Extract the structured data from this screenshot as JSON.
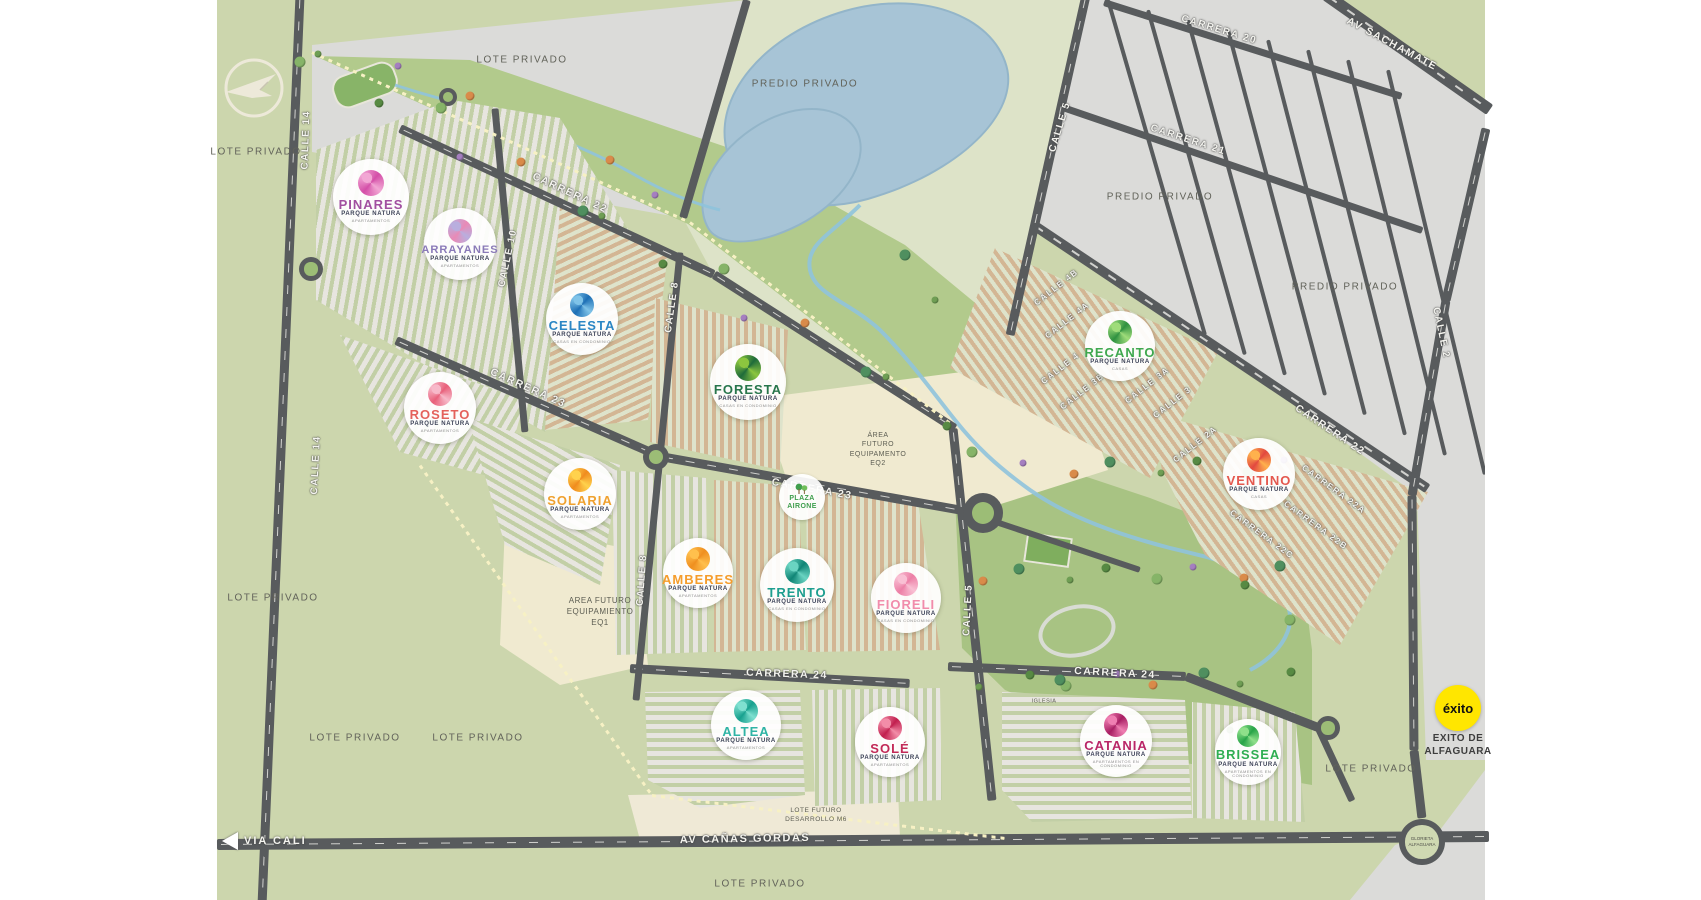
{
  "map": {
    "colors": {
      "page_margin": "#ffffff",
      "base_green": "#ccd6ad",
      "pale_parcel": "#dde3c8",
      "gray_parcel": "#dbdbd9",
      "park_green": "#aec98a",
      "beige_area": "#f0ead0",
      "road": "#585b5d",
      "lake": "#a7c4d6",
      "boundary_dots": "#f7f1c4",
      "exito_yellow": "#ffe600"
    },
    "parcel_labels": [
      {
        "text": "LOTE PRIVADO",
        "x": 256,
        "y": 152
      },
      {
        "text": "LOTE PRIVADO",
        "x": 522,
        "y": 60
      },
      {
        "text": "LOTE PRIVADO",
        "x": 273,
        "y": 598
      },
      {
        "text": "LOTE PRIVADO",
        "x": 355,
        "y": 738
      },
      {
        "text": "LOTE PRIVADO",
        "x": 478,
        "y": 738
      },
      {
        "text": "LOTE PRIVADO",
        "x": 760,
        "y": 884
      },
      {
        "text": "LOTE PRIVADO",
        "x": 1371,
        "y": 769
      },
      {
        "text": "PREDIO PRIVADO",
        "x": 805,
        "y": 84
      },
      {
        "text": "PREDIO PRIVADO",
        "x": 1160,
        "y": 197
      },
      {
        "text": "PREDIO PRIVADO",
        "x": 1345,
        "y": 287
      }
    ],
    "area_labels": [
      {
        "text": "ÁREA\nFUTURO\nEQUIPAMENTO\nEQ2",
        "x": 878,
        "y": 450,
        "size": 7
      },
      {
        "text": "AREA FUTURO\nEQUIPAMIENTO\nEQ1",
        "x": 600,
        "y": 612,
        "size": 8
      },
      {
        "text": "LOTE FUTURO\nDESARROLLO M6",
        "x": 816,
        "y": 816,
        "size": 6.5
      },
      {
        "text": "IGLESIA",
        "x": 1044,
        "y": 702,
        "size": 5.5
      }
    ],
    "street_labels": [
      {
        "text": "CALLE 14",
        "x": 306,
        "y": 140,
        "rot": -88,
        "size": 10
      },
      {
        "text": "CALLE 14",
        "x": 316,
        "y": 465,
        "rot": -87,
        "size": 10
      },
      {
        "text": "CARRERA 22",
        "x": 570,
        "y": 193,
        "rot": 25,
        "size": 10.5
      },
      {
        "text": "CALLE 10",
        "x": 508,
        "y": 258,
        "rot": -78,
        "size": 10
      },
      {
        "text": "CALLE 8",
        "x": 672,
        "y": 307,
        "rot": -82,
        "size": 10
      },
      {
        "text": "CALLE 8",
        "x": 642,
        "y": 580,
        "rot": -86,
        "size": 10
      },
      {
        "text": "CARRERA 23",
        "x": 528,
        "y": 388,
        "rot": 24,
        "size": 10.5
      },
      {
        "text": "CARRERA 23",
        "x": 812,
        "y": 489,
        "rot": 10,
        "size": 10.5
      },
      {
        "text": "CARRERA 24",
        "x": 787,
        "y": 674,
        "rot": 2,
        "size": 10.5
      },
      {
        "text": "CARRERA 24",
        "x": 1115,
        "y": 673,
        "rot": 3,
        "size": 10.5
      },
      {
        "text": "CALLE 5",
        "x": 968,
        "y": 610,
        "rot": -87,
        "size": 10
      },
      {
        "text": "CALLE 5",
        "x": 1060,
        "y": 127,
        "rot": -73,
        "size": 10
      },
      {
        "text": "CARRERA 20",
        "x": 1219,
        "y": 30,
        "rot": 17,
        "size": 10
      },
      {
        "text": "CARRERA 21",
        "x": 1188,
        "y": 140,
        "rot": 18,
        "size": 10
      },
      {
        "text": "AV SACHAMATE",
        "x": 1392,
        "y": 44,
        "rot": 28,
        "size": 10.5
      },
      {
        "text": "CARRERA 22",
        "x": 1330,
        "y": 430,
        "rot": 34,
        "size": 10.5
      },
      {
        "text": "CALLE 2",
        "x": 1441,
        "y": 333,
        "rot": 78,
        "size": 10
      },
      {
        "text": "CALLE 4B",
        "x": 1056,
        "y": 287,
        "rot": -38,
        "size": 8.5
      },
      {
        "text": "CALLE 4A",
        "x": 1067,
        "y": 320,
        "rot": -38,
        "size": 8.5
      },
      {
        "text": "CALLE 4",
        "x": 1060,
        "y": 368,
        "rot": -38,
        "size": 8.5
      },
      {
        "text": "CALLE 3B",
        "x": 1082,
        "y": 391,
        "rot": -38,
        "size": 8.5
      },
      {
        "text": "CALLE 3A",
        "x": 1147,
        "y": 385,
        "rot": -38,
        "size": 8.5
      },
      {
        "text": "CALLE 3",
        "x": 1172,
        "y": 402,
        "rot": -38,
        "size": 8.5
      },
      {
        "text": "CALLE 2A",
        "x": 1195,
        "y": 444,
        "rot": -38,
        "size": 8.5
      },
      {
        "text": "CARRERA 22A",
        "x": 1334,
        "y": 489,
        "rot": 36,
        "size": 8.5
      },
      {
        "text": "CARRERA 22B",
        "x": 1316,
        "y": 525,
        "rot": 36,
        "size": 8.5
      },
      {
        "text": "CARRERA 22C",
        "x": 1262,
        "y": 534,
        "rot": 36,
        "size": 8.5
      },
      {
        "text": "AV CAÑAS GORDAS",
        "x": 745,
        "y": 839,
        "rot": -1,
        "size": 11
      }
    ],
    "projects": [
      {
        "name": "PINARES",
        "brand": "PARQUE NATURA",
        "type": "APARTAMENTOS",
        "color": "#a14fa0",
        "c1": "#f2a7d4",
        "c2": "#d44fa8",
        "x": 371,
        "y": 197,
        "d": 76
      },
      {
        "name": "ARRAYANES",
        "brand": "PARQUE NATURA",
        "type": "APARTAMENTOS",
        "color": "#8a7ab8",
        "c1": "#b9aede",
        "c2": "#e98ab6",
        "x": 460,
        "y": 244,
        "d": 72
      },
      {
        "name": "CELESTA",
        "brand": "PARQUE NATURA",
        "type": "CASAS EN CONDOMINIO",
        "color": "#2b86c4",
        "c1": "#7fc3e8",
        "c2": "#1d6fb5",
        "x": 582,
        "y": 319,
        "d": 72
      },
      {
        "name": "FORESTA",
        "brand": "PARQUE NATURA",
        "type": "CASAS EN CONDOMINIO",
        "color": "#28764c",
        "c1": "#8cc63f",
        "c2": "#1e6b3a",
        "x": 748,
        "y": 382,
        "d": 76
      },
      {
        "name": "ROSETO",
        "brand": "PARQUE NATURA",
        "type": "APARTAMENTOS",
        "color": "#e4625c",
        "c1": "#f7b9c9",
        "c2": "#e8607a",
        "x": 440,
        "y": 408,
        "d": 72
      },
      {
        "name": "SOLARIA",
        "brand": "PARQUE NATURA",
        "type": "APARTAMENTOS",
        "color": "#f0a12f",
        "c1": "#ffd24d",
        "c2": "#f08c1e",
        "x": 580,
        "y": 494,
        "d": 72
      },
      {
        "name": "AMBERES",
        "brand": "PARQUE NATURA",
        "type": "APARTAMENTOS",
        "color": "#f59d2c",
        "c1": "#ffc04d",
        "c2": "#ef8f1f",
        "x": 698,
        "y": 573,
        "d": 70
      },
      {
        "name": "TRENTO",
        "brand": "PARQUE NATURA",
        "type": "CASAS EN CONDOMINIO",
        "color": "#1d9e8f",
        "c1": "#6ad4c2",
        "c2": "#0f8475",
        "x": 797,
        "y": 585,
        "d": 74
      },
      {
        "name": "FIORELI",
        "brand": "PARQUE NATURA",
        "type": "CASAS EN CONDOMINIO",
        "color": "#f18cab",
        "c1": "#f9c0d4",
        "c2": "#ec7fa6",
        "x": 906,
        "y": 598,
        "d": 70
      },
      {
        "name": "RECANTO",
        "brand": "PARQUE NATURA",
        "type": "CASAS",
        "color": "#3fa84f",
        "c1": "#9fdc7a",
        "c2": "#2f9140",
        "x": 1120,
        "y": 346,
        "d": 70
      },
      {
        "name": "VENTINO",
        "brand": "PARQUE NATURA",
        "type": "CASAS",
        "color": "#e4584e",
        "c1": "#ffb14d",
        "c2": "#e2483f",
        "x": 1259,
        "y": 474,
        "d": 72
      },
      {
        "name": "ALTEA",
        "brand": "PARQUE NATURA",
        "type": "APARTAMENTOS",
        "color": "#2fb4a5",
        "c1": "#7fe0d0",
        "c2": "#17a08e",
        "x": 746,
        "y": 725,
        "d": 70
      },
      {
        "name": "SOLÉ",
        "brand": "PARQUE NATURA",
        "type": "APARTAMENTOS",
        "color": "#c22a57",
        "c1": "#f28da8",
        "c2": "#c11f4e",
        "x": 890,
        "y": 742,
        "d": 70
      },
      {
        "name": "CATANIA",
        "brand": "PARQUE NATURA",
        "type": "APARTAMENTOS EN CONDOMINIO",
        "color": "#b92667",
        "c1": "#ef7fb2",
        "c2": "#a81f63",
        "x": 1116,
        "y": 741,
        "d": 72
      },
      {
        "name": "BRISSEA",
        "brand": "PARQUE NATURA",
        "type": "APARTAMENTOS EN CONDOMINIO",
        "color": "#2fae52",
        "c1": "#8fe08a",
        "c2": "#26a347",
        "x": 1248,
        "y": 752,
        "d": 66
      }
    ],
    "pois": {
      "exito": {
        "label": "éxito",
        "sub": "EXITO DE\nALFAGUARA",
        "color": "#ffe600",
        "x": 1458,
        "y": 708,
        "d": 46
      },
      "plaza": {
        "label": "PLAZA\nAIRONE",
        "color": "#3f9e4d",
        "x": 802,
        "y": 497,
        "d": 46
      },
      "via_cali": {
        "label": "VIA CALI",
        "x": 230,
        "y": 841
      },
      "glorieta": {
        "label": "GLORIETA\nALFAGUARA",
        "x": 1422,
        "y": 842,
        "d": 46
      }
    }
  }
}
